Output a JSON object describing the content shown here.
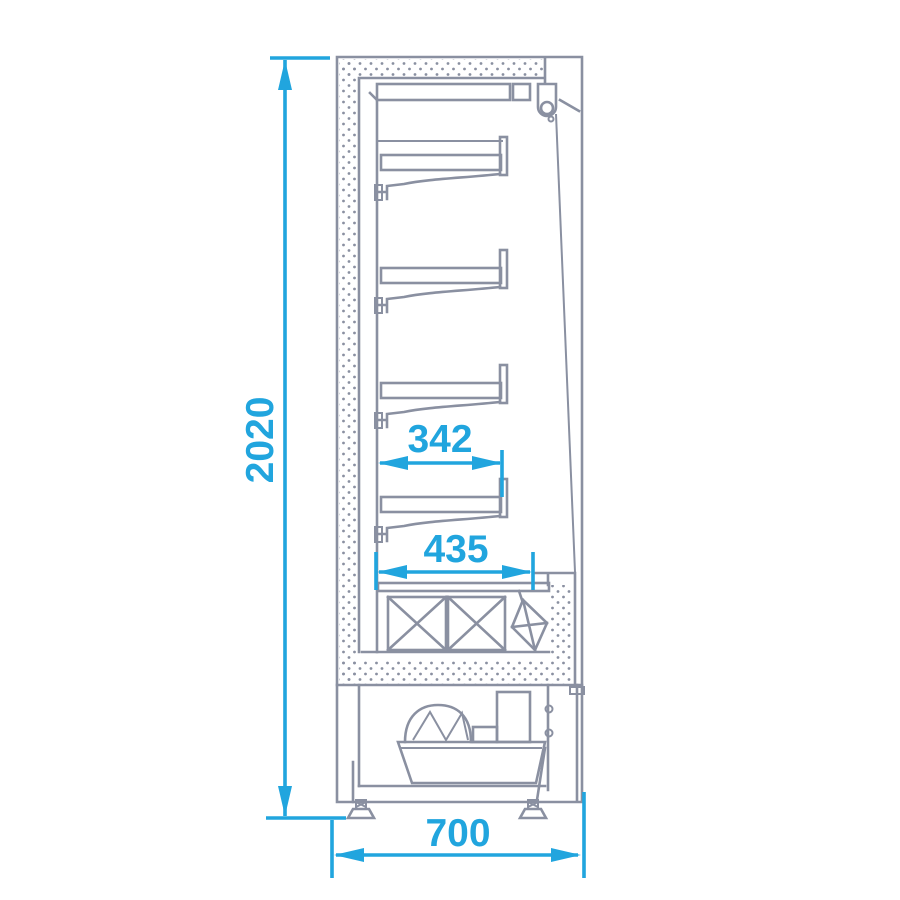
{
  "drawing": {
    "type": "technical-section-drawing",
    "subject": "Refrigerated multideck display cabinet - side cross-section",
    "shelf_count": 4,
    "colors": {
      "dimension_blue": "#21A5DE",
      "line_gray": "#8A90A1",
      "background": "#FFFFFF"
    },
    "dimensions": {
      "overall_height": {
        "label": "2020"
      },
      "shelf_depth": {
        "label": "342"
      },
      "well_depth": {
        "label": "435"
      },
      "overall_depth": {
        "label": "700"
      }
    }
  }
}
